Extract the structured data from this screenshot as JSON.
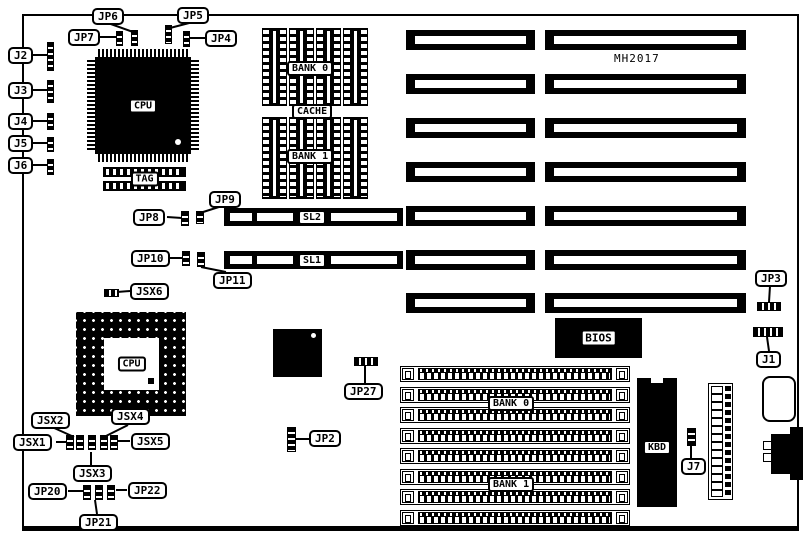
{
  "diagram": {
    "part_number": "MH2017",
    "callouts": {
      "jp6": "JP6",
      "jp5": "JP5",
      "jp7": "JP7",
      "jp4": "JP4",
      "j2": "J2",
      "j3": "J3",
      "j4": "J4",
      "j5": "J5",
      "j6": "J6",
      "jp8": "JP8",
      "jp9": "JP9",
      "jp10": "JP10",
      "jp11": "JP11",
      "jsx6": "JSX6",
      "jp3": "JP3",
      "j1": "J1",
      "jp27": "JP27",
      "jp2": "JP2",
      "j7": "J7",
      "jsx1": "JSX1",
      "jsx2": "JSX2",
      "jsx3": "JSX3",
      "jsx4": "JSX4",
      "jsx5": "JSX5",
      "jp20": "JP20",
      "jp21": "JP21",
      "jp22": "JP22"
    },
    "components": {
      "cpu1": "CPU",
      "cpu2": "CPU",
      "tag": "TAG",
      "cache_bank0": "BANK 0",
      "cache": "CACHE",
      "cache_bank1": "BANK 1",
      "sl2": "SL2",
      "sl1": "SL1",
      "bios": "BIOS",
      "kbd": "KBD",
      "simm_bank0": "BANK 0",
      "simm_bank1": "BANK 1"
    }
  }
}
